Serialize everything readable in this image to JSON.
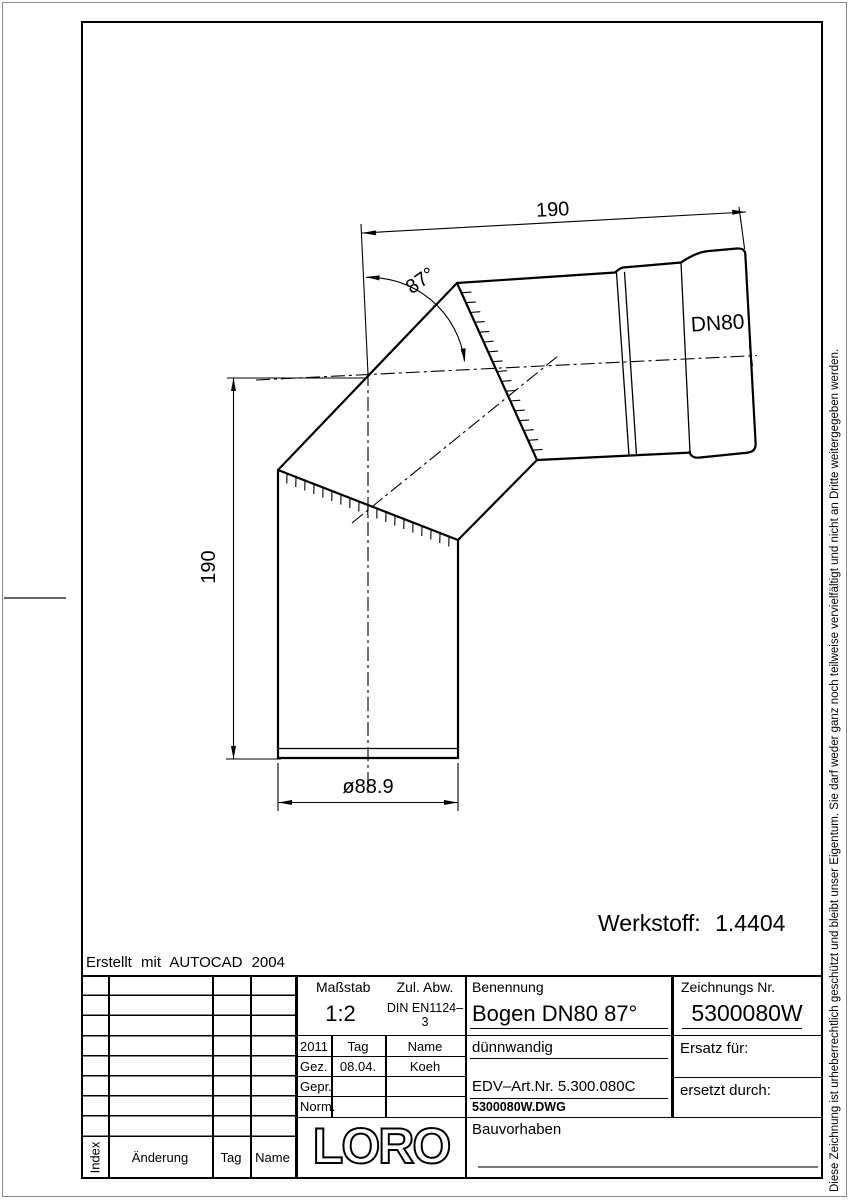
{
  "page": {
    "created_with": "Erstellt mit AUTOCAD 2004",
    "werkstoff": "Werkstoff: 1.4404",
    "copyright_vertical": "Diese Zeichnung ist urheberrechtlich geschützt und bleibt unser Eigentum. Sie darf weder ganz noch teilweise vervielfältigt und nicht an Dritte weitergegeben werden."
  },
  "drawing": {
    "dim_top": "190",
    "dim_left": "190",
    "dim_diameter": "ø88.9",
    "dim_angle": "87°",
    "label_dn": "DN80"
  },
  "titleblock": {
    "massstab_label": "Maßstab",
    "massstab_value": "1:2",
    "zul_abw_label": "Zul. Abw.",
    "zul_abw_value": "DIN EN1124–3",
    "benennung_label": "Benennung",
    "benennung_value": "Bogen DN80 87°",
    "zeichnungs_label": "Zeichnungs Nr.",
    "zeichnungs_value": "5300080W",
    "subtitle": "dünnwandig",
    "edv_art": "EDV–Art.Nr. 5.300.080C",
    "dwg_file": "5300080W.DWG",
    "ersatz_label": "Ersatz für:",
    "ersetzt_label": "ersetzt durch:",
    "bauvorhaben_label": "Bauvorhaben",
    "logo": "LORO",
    "approval": {
      "year": "2011",
      "col_tag": "Tag",
      "col_name": "Name",
      "rows": [
        {
          "label": "Gez.",
          "tag": "08.04.",
          "name": "Koeh"
        },
        {
          "label": "Gepr.",
          "tag": "",
          "name": ""
        },
        {
          "label": "Norm.",
          "tag": "",
          "name": ""
        }
      ]
    },
    "revision": {
      "col_index": "Index",
      "col_aenderung": "Änderung",
      "col_tag": "Tag",
      "col_name": "Name"
    }
  }
}
